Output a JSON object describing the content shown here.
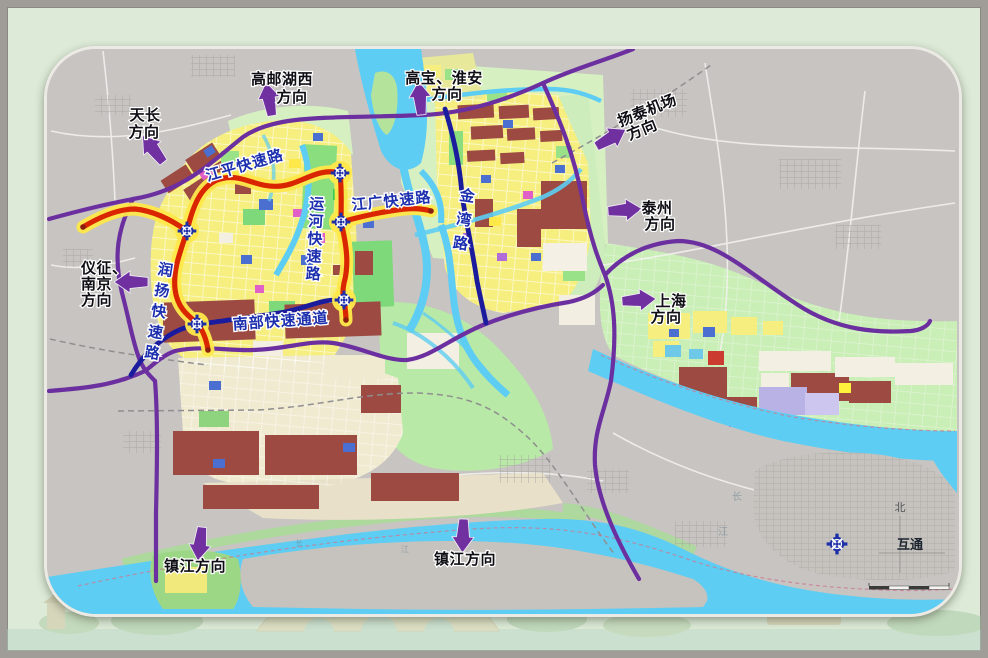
{
  "map_title_context": {
    "description_note": ""
  },
  "direction_labels": {
    "tianchang": {
      "line1": "天长",
      "line2": "方向"
    },
    "gaoyouhuxi": {
      "line1": "高邮湖西",
      "line2": "方向"
    },
    "gaobao_huaian": {
      "line1": "高宝、淮安",
      "line2": "方向"
    },
    "yangtai_airport": {
      "line1": "扬泰机场",
      "line2": "方向"
    },
    "taizhou": {
      "line1": "泰州",
      "line2": "方向"
    },
    "shanghai": {
      "line1": "上海",
      "line2": "方向"
    },
    "yizheng_nanjing": {
      "line1": "仪征、",
      "line2": "南京",
      "line3": "方向"
    },
    "zhenjiang_west": {
      "label": "镇江方向"
    },
    "zhenjiang_east": {
      "label": "镇江方向"
    }
  },
  "road_labels": {
    "jiangping": "江平快速路",
    "jiangguang": "江广快速路",
    "yunhe": "运河快速路",
    "jinwan": "金湾路",
    "runyang": "润扬快速路",
    "nanbu": "南部快速通道"
  },
  "legend": {
    "north_label": "北",
    "interchange_label": "互通"
  },
  "river_chars": {
    "pair1_a": "长",
    "pair1_b": "江",
    "pair2_a": "长",
    "pair2_b": "江"
  },
  "colors": {
    "expressway_red": "#d92600",
    "expressway_halo": "#ffe84a",
    "arterial_navy": "#1b1b9e",
    "highway_purple": "#6b2fa0",
    "arrow_purple": "#7030a0",
    "road_label_blue": "#1c2fae",
    "water_cyan": "#5ecdf3",
    "urban_yellow": "#f6ee7e",
    "green_parcel": "#8ade7e",
    "maroon_parcel": "#9c4a42",
    "grey_land": "#c7c4c1",
    "slide_background": "#dcead7"
  }
}
